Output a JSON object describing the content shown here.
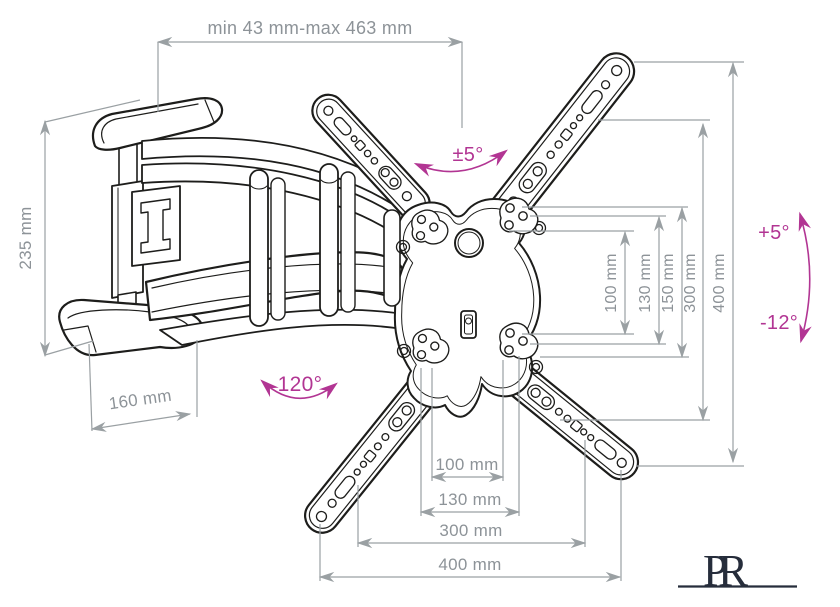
{
  "drawing": {
    "subject": "Articulating TV wall-mount bracket dimensional diagram"
  },
  "colors": {
    "line_art": "#1d1d1b",
    "dimension_line": "#9aa0a3",
    "dimension_text": "#8d9398",
    "accent_magenta": "#b23593",
    "logo_navy": "#262d3b",
    "background": "#ffffff"
  },
  "dims": {
    "top": "min 43 mm-max 463 mm",
    "left": "235 mm",
    "depth": "160 mm",
    "vertical": [
      "100 mm",
      "130 mm",
      "150 mm",
      "300 mm",
      "400 mm"
    ],
    "horizontal": [
      "100 mm",
      "130 mm",
      "300 mm",
      "400 mm"
    ]
  },
  "angles": {
    "pan": "±5°",
    "swivel": "120°",
    "tilt_up": "+5°",
    "tilt_down": "-12°"
  },
  "logo": {
    "p": "P",
    "r": "R"
  }
}
